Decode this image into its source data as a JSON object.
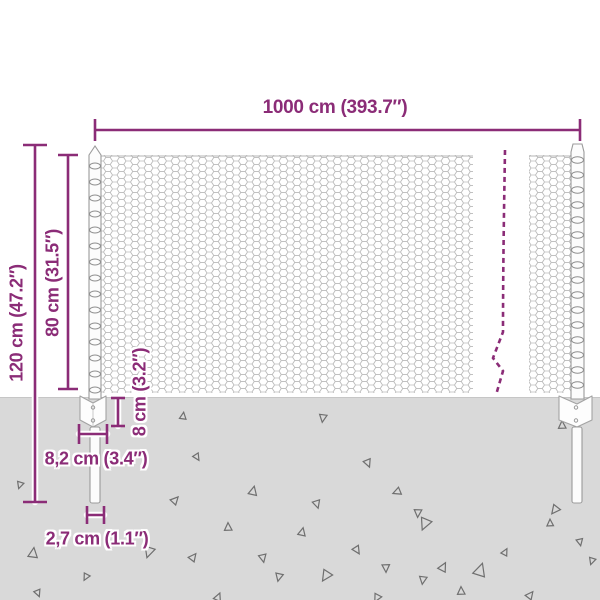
{
  "title": "Wire mesh fence dimension diagram",
  "colors": {
    "accent": "#8b2c77",
    "ground": "#d9d9d9",
    "mesh_wire": "#bdbdbd",
    "post_stroke": "#9b9b9b",
    "triangle_stroke": "#6f6f6f"
  },
  "dimensions": {
    "total_width": {
      "label": "1000 cm (393.7″)"
    },
    "total_height": {
      "label": "120 cm (47.2″)"
    },
    "mesh_height": {
      "label": "80 cm (31.5″)"
    },
    "plate_height": {
      "label": "8 cm (3.2″)"
    },
    "plate_width": {
      "label": "8,2 cm (3.4″)"
    },
    "spike_width": {
      "label": "2,7 cm (1.1″)"
    }
  },
  "ground": {
    "triangles": [
      [
        183,
        416,
        7,
        10
      ],
      [
        323,
        418,
        8,
        190
      ],
      [
        20,
        485,
        7,
        200
      ],
      [
        197,
        457,
        7,
        150
      ],
      [
        368,
        463,
        8,
        160
      ],
      [
        253,
        491,
        9,
        15
      ],
      [
        397,
        492,
        8,
        250
      ],
      [
        317,
        504,
        8,
        165
      ],
      [
        418,
        513,
        8,
        185
      ],
      [
        443,
        567,
        9,
        30
      ],
      [
        562,
        425,
        8,
        0
      ],
      [
        555,
        510,
        9,
        220
      ],
      [
        175,
        500,
        8,
        45
      ],
      [
        33,
        553,
        10,
        10
      ],
      [
        86,
        577,
        7,
        210
      ],
      [
        38,
        593,
        7,
        160
      ],
      [
        149,
        552,
        11,
        200
      ],
      [
        193,
        557,
        8,
        40
      ],
      [
        228,
        527,
        8,
        0
      ],
      [
        263,
        558,
        8,
        170
      ],
      [
        302,
        532,
        8,
        15
      ],
      [
        279,
        577,
        8,
        195
      ],
      [
        326,
        576,
        11,
        215
      ],
      [
        357,
        550,
        8,
        150
      ],
      [
        386,
        568,
        8,
        180
      ],
      [
        425,
        524,
        12,
        205
      ],
      [
        480,
        570,
        13,
        20
      ],
      [
        461,
        591,
        8,
        0
      ],
      [
        505,
        552,
        7,
        30
      ],
      [
        423,
        580,
        8,
        190
      ],
      [
        550,
        523,
        7,
        0
      ],
      [
        580,
        542,
        7,
        170
      ],
      [
        530,
        595,
        8,
        40
      ],
      [
        377,
        598,
        8,
        210
      ],
      [
        218,
        597,
        8,
        25
      ],
      [
        592,
        561,
        7,
        200
      ]
    ]
  }
}
